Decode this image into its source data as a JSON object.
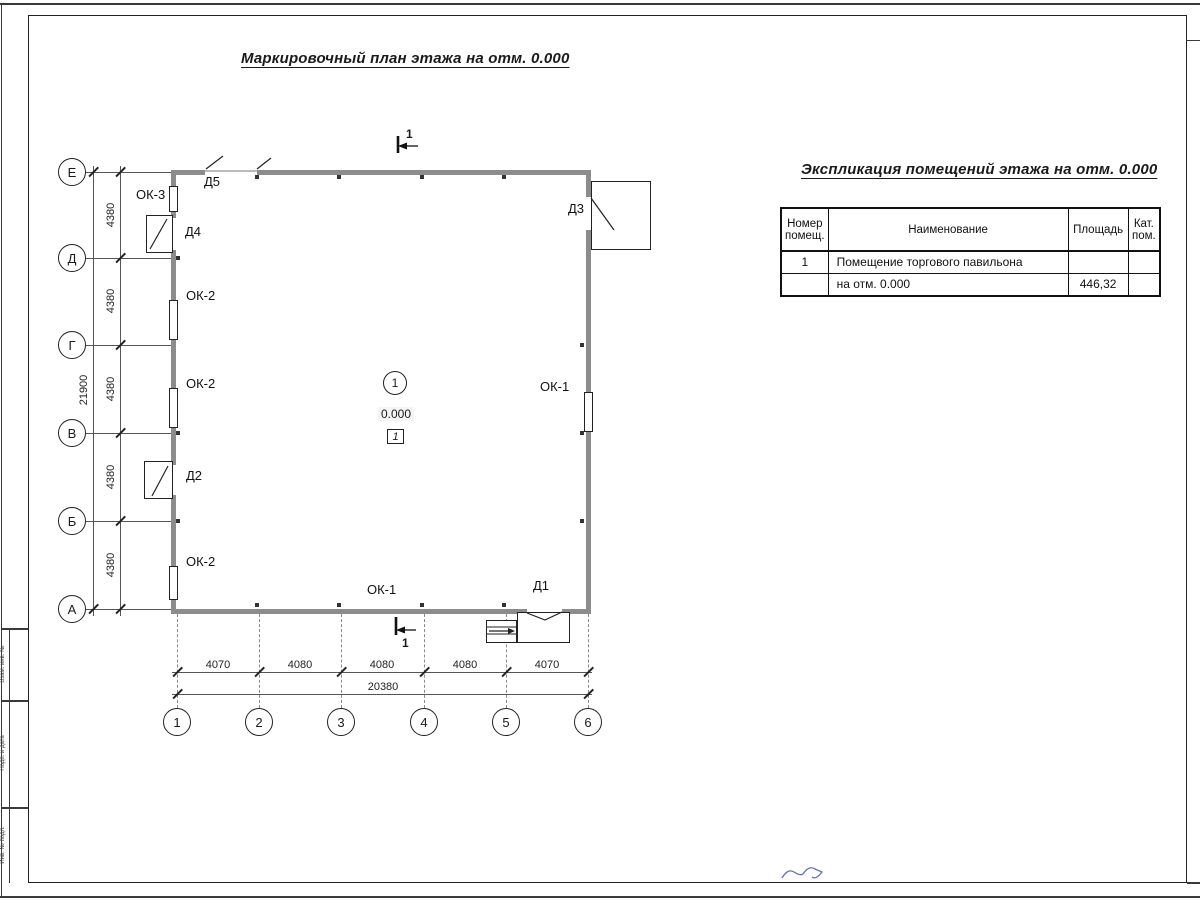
{
  "frame": {
    "stamp_cells": [
      "Взам. инв. №",
      "Подп. и дата",
      "Инв. № подл."
    ]
  },
  "plan": {
    "title": "Маркировочный план этажа на отм. 0.000",
    "section_label": "1",
    "room_badge": "1",
    "elevation_mark": "0.000",
    "floor_type_mark": "1",
    "row_axes": [
      "Е",
      "Д",
      "Г",
      "В",
      "Б",
      "А"
    ],
    "col_axes": [
      "1",
      "2",
      "3",
      "4",
      "5",
      "6"
    ],
    "dims_left": [
      "4380",
      "4380",
      "4380",
      "4380",
      "4380"
    ],
    "dim_left_total": "21900",
    "dims_bottom": [
      "4070",
      "4080",
      "4080",
      "4080",
      "4070"
    ],
    "dim_bottom_total": "20380",
    "labels": {
      "d1": "Д1",
      "d2": "Д2",
      "d3": "Д3",
      "d4": "Д4",
      "d5": "Д5",
      "ok1_right": "ОК-1",
      "ok1_bottom": "ОК-1",
      "ok2_top": "ОК-2",
      "ok2_mid": "ОК-2",
      "ok2_bottom": "ОК-2",
      "ok3": "ОК-3"
    }
  },
  "table": {
    "title": "Экспликация помещений этажа на отм. 0.000",
    "headers": {
      "number": "Номер помещ.",
      "name": "Наименование",
      "area": "Площадь",
      "category": "Кат. пом."
    },
    "rows": [
      {
        "number": "1",
        "name": "Помещение торгового павильона",
        "area": "",
        "category": ""
      },
      {
        "number": "",
        "name": "на отм. 0.000",
        "area": "446,32",
        "category": ""
      }
    ]
  },
  "colors": {
    "line": "#222222",
    "wall": "#8c8c8c",
    "signature": "#4856b5"
  }
}
